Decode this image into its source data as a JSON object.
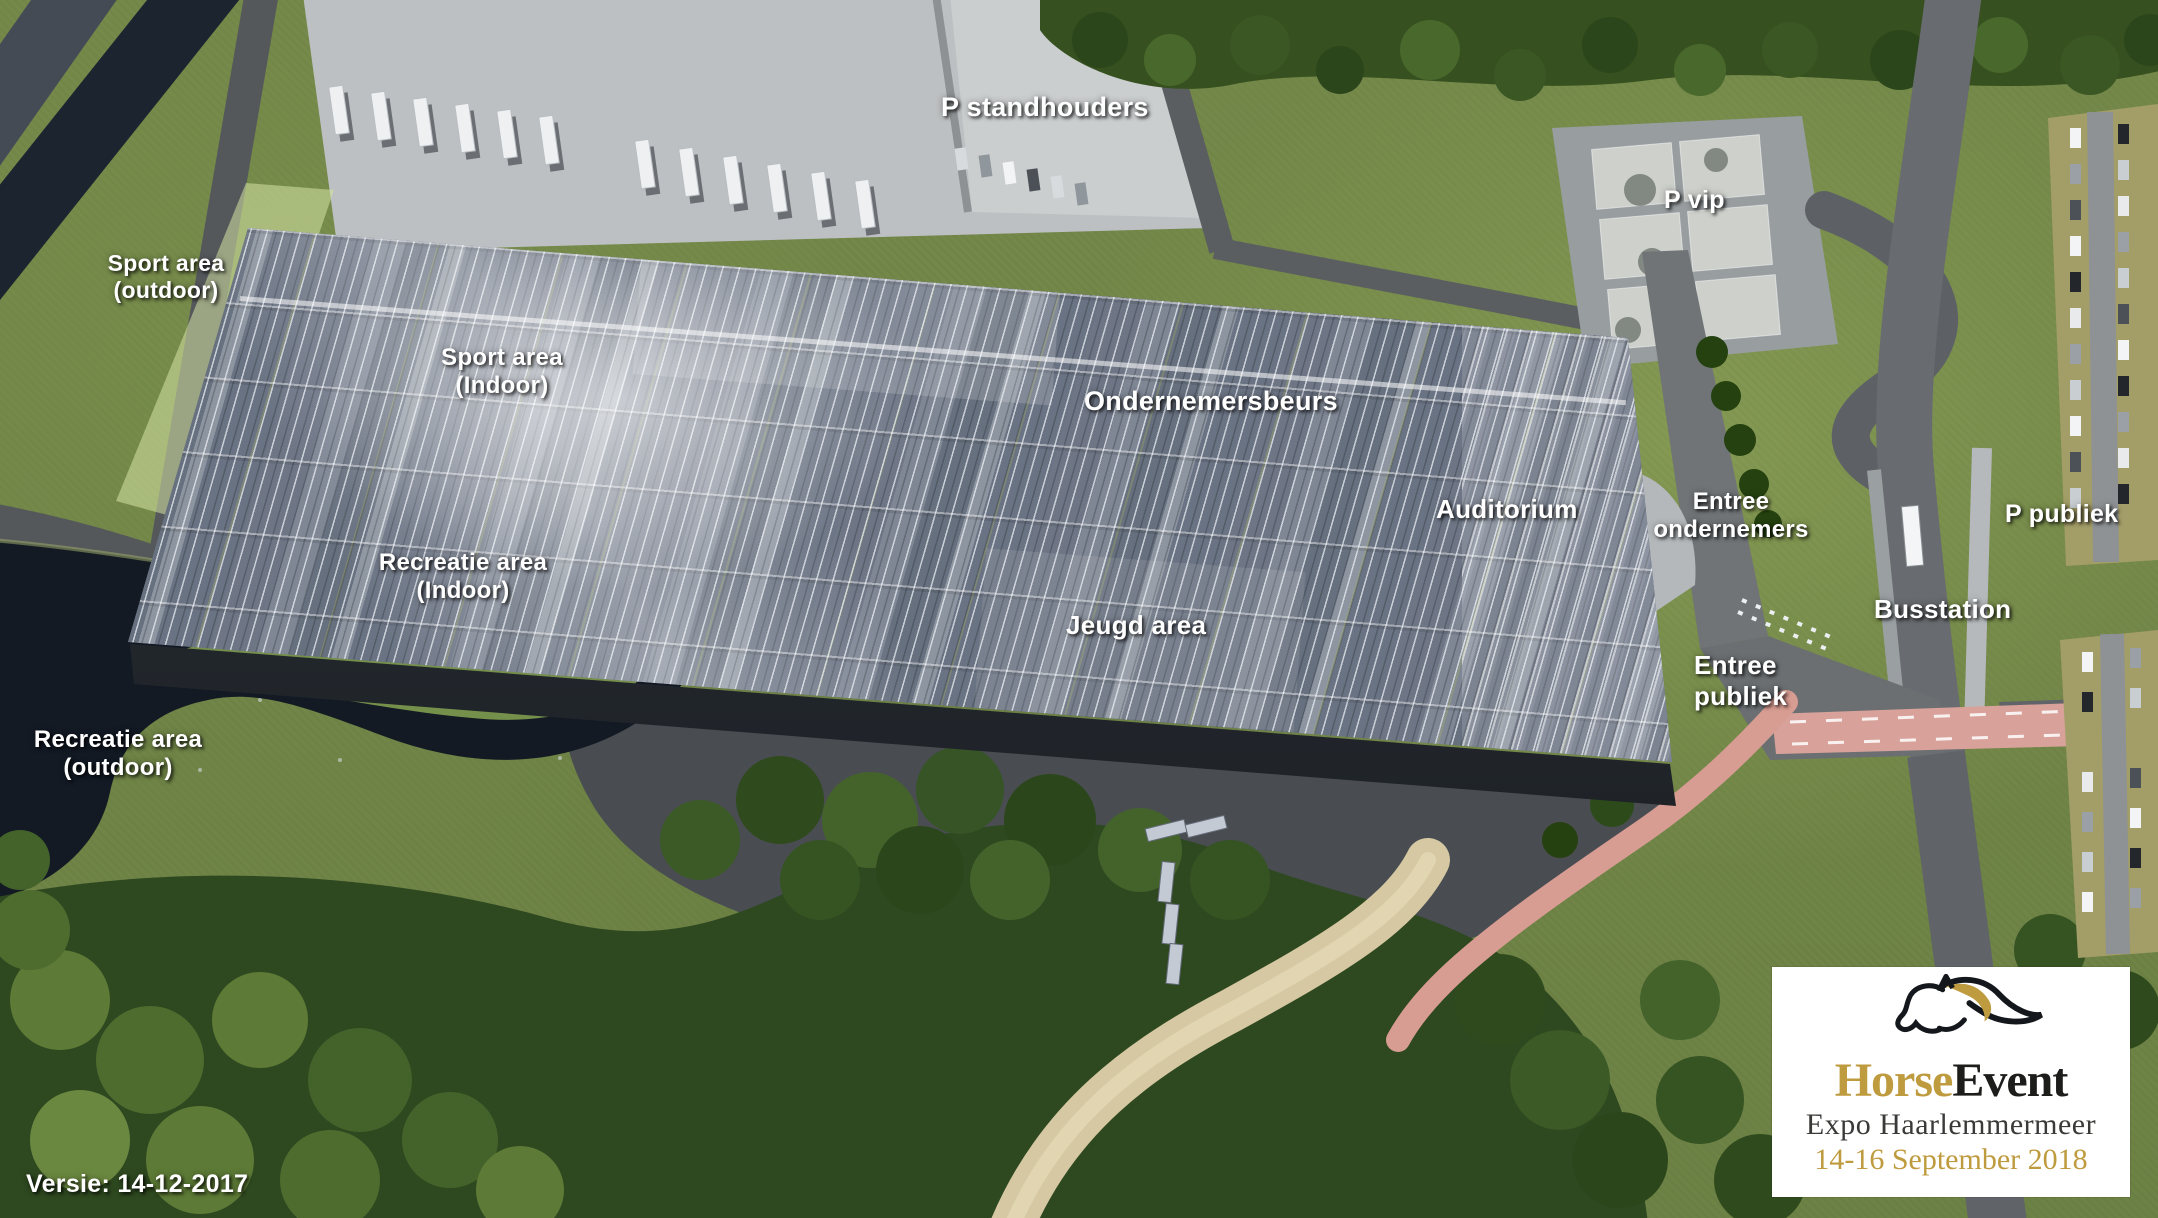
{
  "map_labels": {
    "p_standhouders": "P standhouders",
    "sport_area_outdoor": "Sport area\n(outdoor)",
    "sport_area_indoor": "Sport area\n(Indoor)",
    "recreatie_area_indoor": "Recreatie area\n(Indoor)",
    "recreatie_area_outdoor": "Recreatie area\n(outdoor)",
    "ondernemersbeurs": "Ondernemersbeurs",
    "auditorium": "Auditorium",
    "jeugd_area": "Jeugd area",
    "entree_ondernemers": "Entree\nondernemers",
    "entree_publiek": "Entree\npubliek",
    "p_vip": "P vip",
    "p_publiek": "P publiek",
    "busstation": "Busstation"
  },
  "version_note": "Versie: 14-12-2017",
  "logo": {
    "title_primary": "Horse",
    "title_secondary": "Event",
    "subtitle": "Expo Haarlemmermeer",
    "dates": "14-16 September 2018"
  },
  "colors": {
    "logo_gold": "#bf9b3f",
    "logo_black": "#1d1d1b",
    "label_text": "#ffffff",
    "grass": "#74884a",
    "water": "#131a24",
    "roof": "#6a7383",
    "road": "#5d6165",
    "parking": "#bdc0c2",
    "path_sand": "#d5c8a2",
    "path_pink": "#d79c92"
  }
}
